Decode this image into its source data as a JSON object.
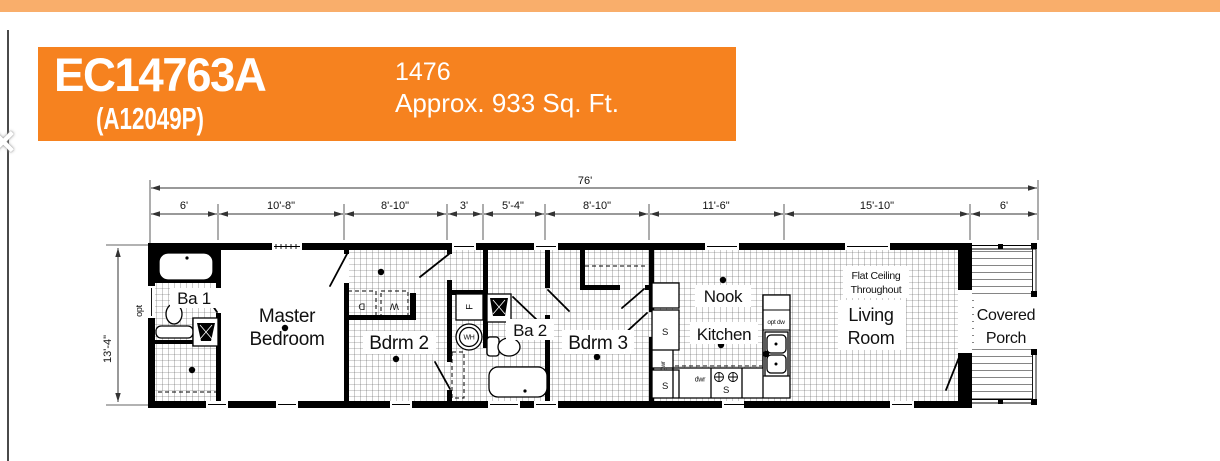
{
  "chrome": {
    "close_icon": "✕"
  },
  "colors": {
    "accent": "#F6821F",
    "accent_light": "#F9AE6B"
  },
  "header": {
    "model": "EC14763A",
    "model_code": "(A12049P)",
    "plan_number": "1476",
    "sqft_text": "Approx. 933 Sq. Ft."
  },
  "dimensions": {
    "overall_width": "76'",
    "overall_depth": "13'-4\"",
    "segments": [
      "6'",
      "10'-8\"",
      "8'-10\"",
      "3'",
      "5'-4\"",
      "8'-10\"",
      "11'-6\"",
      "15'-10\"",
      "6'"
    ]
  },
  "rooms": {
    "ba1": "Ba 1",
    "master_line1": "Master",
    "master_line2": "Bedroom",
    "bdrm2": "Bdrm 2",
    "ba2": "Ba 2",
    "bdrm3": "Bdrm 3",
    "nook": "Nook",
    "kitchen": "Kitchen",
    "ceiling_note_line1": "Flat Ceiling",
    "ceiling_note_line2": "Throughout",
    "living_line1": "Living",
    "living_line2": "Room",
    "porch_line1": "Covered",
    "porch_line2": "Porch"
  },
  "fixtures": {
    "opt_window": "opt",
    "dryer": "D",
    "washer": "W",
    "furnace": "F",
    "water_heater": "WH",
    "shelf1": "S",
    "shelf2": "S",
    "shelf3": "S",
    "drawer1": "dwr",
    "drawer2": "dwr",
    "opt_dishwasher": "opt dw"
  }
}
